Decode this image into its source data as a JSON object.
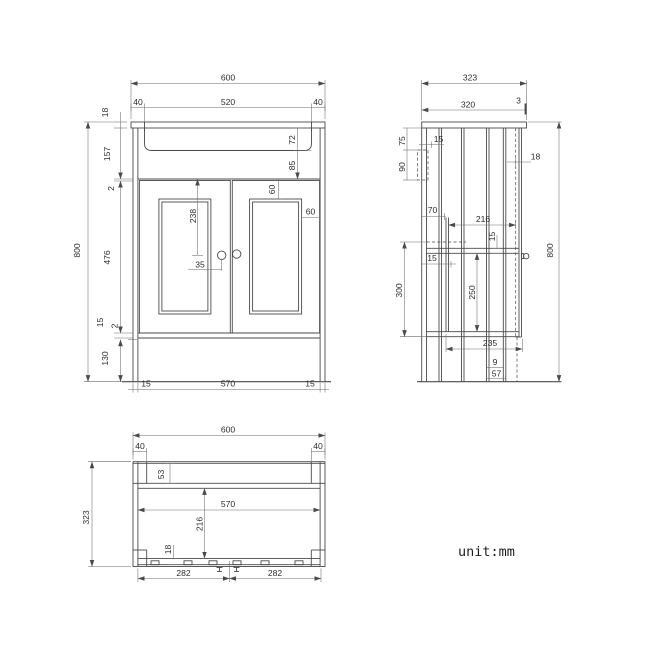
{
  "unit_label": "unit:mm",
  "front": {
    "overall_width": "600",
    "end_overhang": "40",
    "basin_width": "520",
    "worktop_thickness": "18",
    "overall_height": "800",
    "apron_height": "157",
    "reveal_gap": "2",
    "door_height": "476",
    "bottom_rail": "15",
    "plinth_height": "130",
    "side_panel_thickness": "15",
    "internal_width": "570",
    "basin_depth": "72",
    "basin_to_door": "85",
    "door_panel_inset": "60",
    "handle_from_top": "238",
    "handle_offset": "35"
  },
  "side": {
    "overall_depth": "323",
    "body_depth": "320",
    "front_lip": "3",
    "bracket_drop": "75",
    "bracket_inset": "15",
    "bracket_height": "90",
    "door_thickness": "18",
    "overall_height": "800",
    "shelf_back_offset": "70",
    "shelf_depth": "216",
    "shelf_thickness": "15",
    "rail_thickness": "15",
    "shelf_drop": "300",
    "shelf_to_bottom": "250",
    "bottom_depth": "235",
    "plinth_lip": "9",
    "plinth_recess": "57"
  },
  "bottom": {
    "overall_width": "600",
    "end_overhang": "40",
    "overall_depth": "323",
    "back_rail_width": "53",
    "internal_width": "570",
    "internal_depth": "216",
    "front_rail_width": "18",
    "fixing_spacing": "282"
  }
}
